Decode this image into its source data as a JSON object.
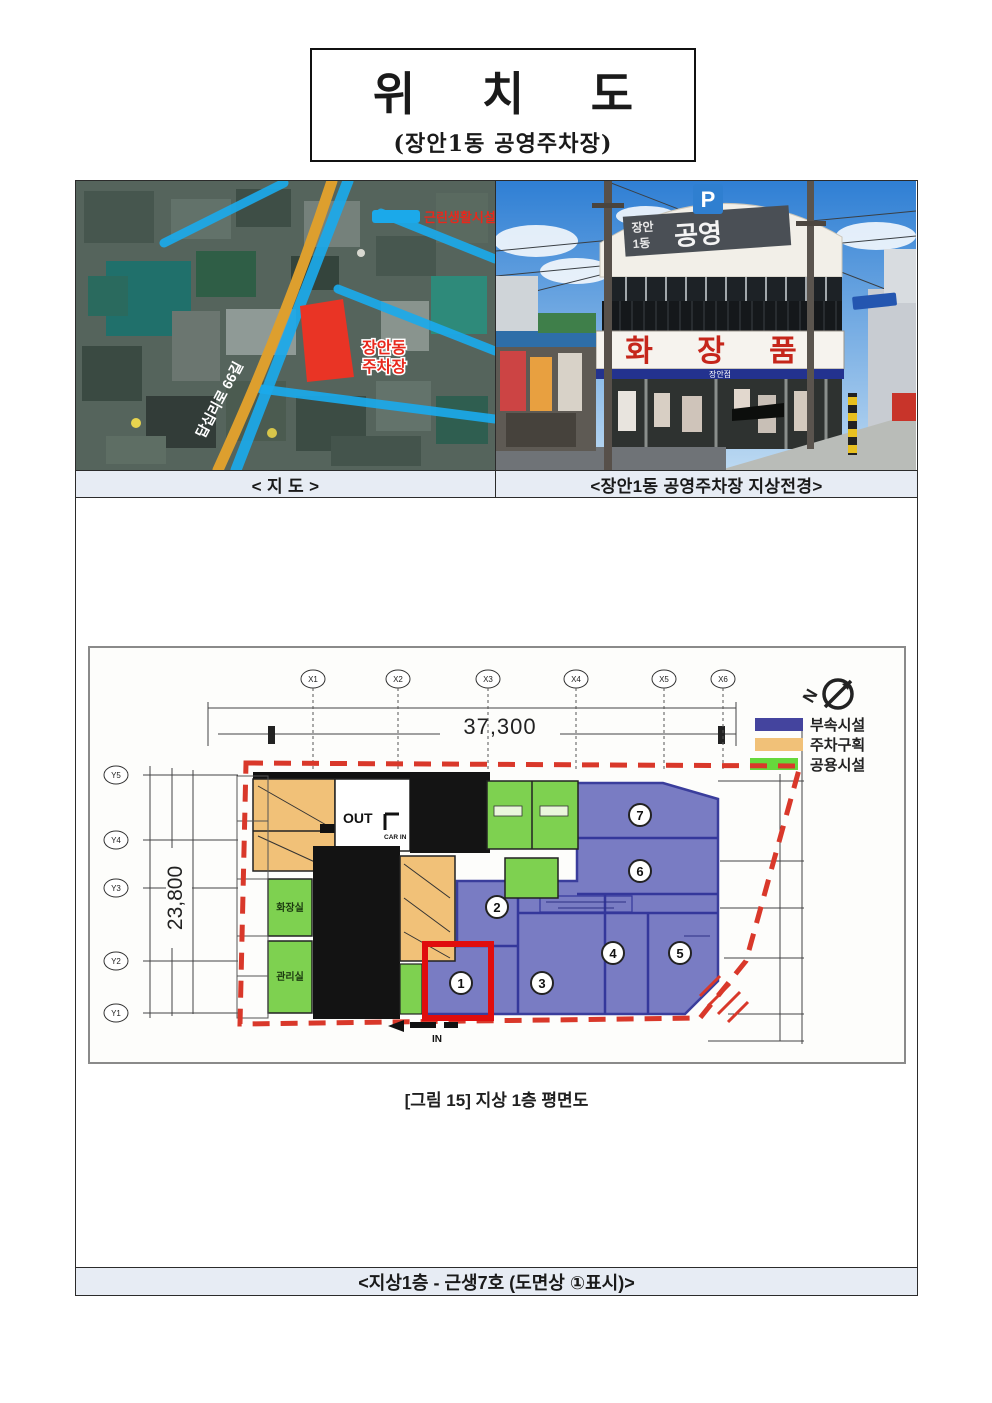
{
  "page": {
    "title": "위 치 도",
    "subtitle": "(장안1동 공영주차장)"
  },
  "captions": {
    "map": "< 지 도 >",
    "photo": "<장안1동 공영주차장 지상전경>",
    "figure": "[그림 15] 지상 1층 평면도",
    "bottom": "<지상1층 - 근생7호 (도면상 ①표시)>"
  },
  "map": {
    "facility_label": "근린생활시설",
    "parking_label_line1": "장안동",
    "parking_label_line2": "주차장",
    "road_label": "답십리로 66길"
  },
  "photo": {
    "p_sign": "P",
    "top_sign_line1": "장안",
    "top_sign_line2": "1동",
    "top_sign_main": "공영",
    "cosmetics_sign": "화 장 품",
    "store_name": "장안점"
  },
  "plan": {
    "north_label": "N",
    "legend": [
      {
        "label": "부속시설",
        "color": "#44449e"
      },
      {
        "label": "주차구획",
        "color": "#f1c178"
      },
      {
        "label": "공용시설",
        "color": "#66d83c"
      }
    ],
    "dims": {
      "width": "37,300",
      "height": "23,800"
    },
    "grid_x": [
      "X1",
      "X2",
      "X3",
      "X4",
      "X5",
      "X6"
    ],
    "grid_y": [
      "Y5",
      "Y4",
      "Y3",
      "Y2",
      "Y1"
    ],
    "rooms": {
      "toilet": "화장실",
      "office": "관리실"
    },
    "flow": {
      "out": "OUT",
      "car_in": "CAR IN",
      "in": "IN"
    },
    "units": [
      "1",
      "2",
      "3",
      "4",
      "5",
      "6",
      "7"
    ]
  },
  "colors": {
    "caption_bg": "#e7ecf4",
    "annex_fill": "#797cc3",
    "annex_stroke": "#3a3d9c",
    "parking_fill": "#f1c178",
    "common_fill": "#7ed150",
    "boundary_red": "#d9382a",
    "highlight_red": "#e00d0d",
    "map_road_blue": "#1ba9ea",
    "map_road_orange": "#dd9f2e",
    "map_parcel_red": "#e93425"
  }
}
